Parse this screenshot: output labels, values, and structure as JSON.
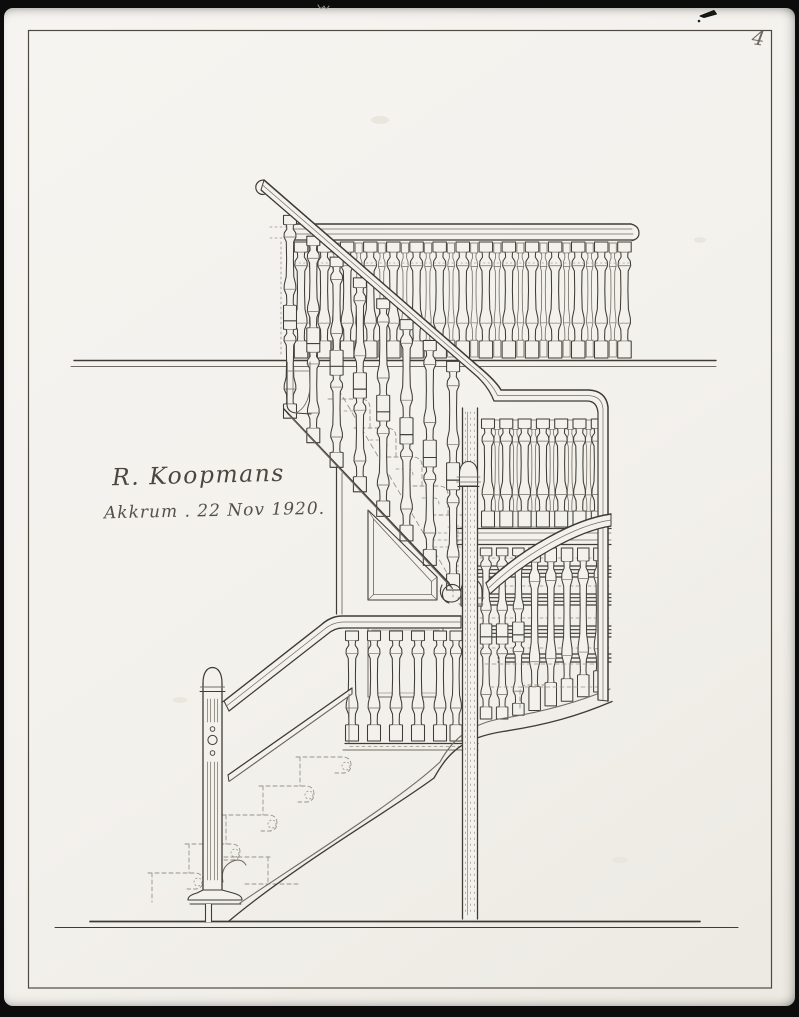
{
  "sheet": {
    "page_number": "4",
    "signature_name": "R. Koopmans",
    "signature_place_date": "Akkrum . 22 Nov 1920.",
    "drawing_alt": "Pen-and-ink elevation drawing of a wooden staircase with turned balusters, newel post, half landing and winders"
  },
  "colors": {
    "scan_bg": "#0c0c0c",
    "paper": "#f3f1ec",
    "ink": "#3f3c37",
    "ink_light": "#716c63",
    "ink_dashed": "#97938a",
    "frame": "#4e4a42"
  }
}
